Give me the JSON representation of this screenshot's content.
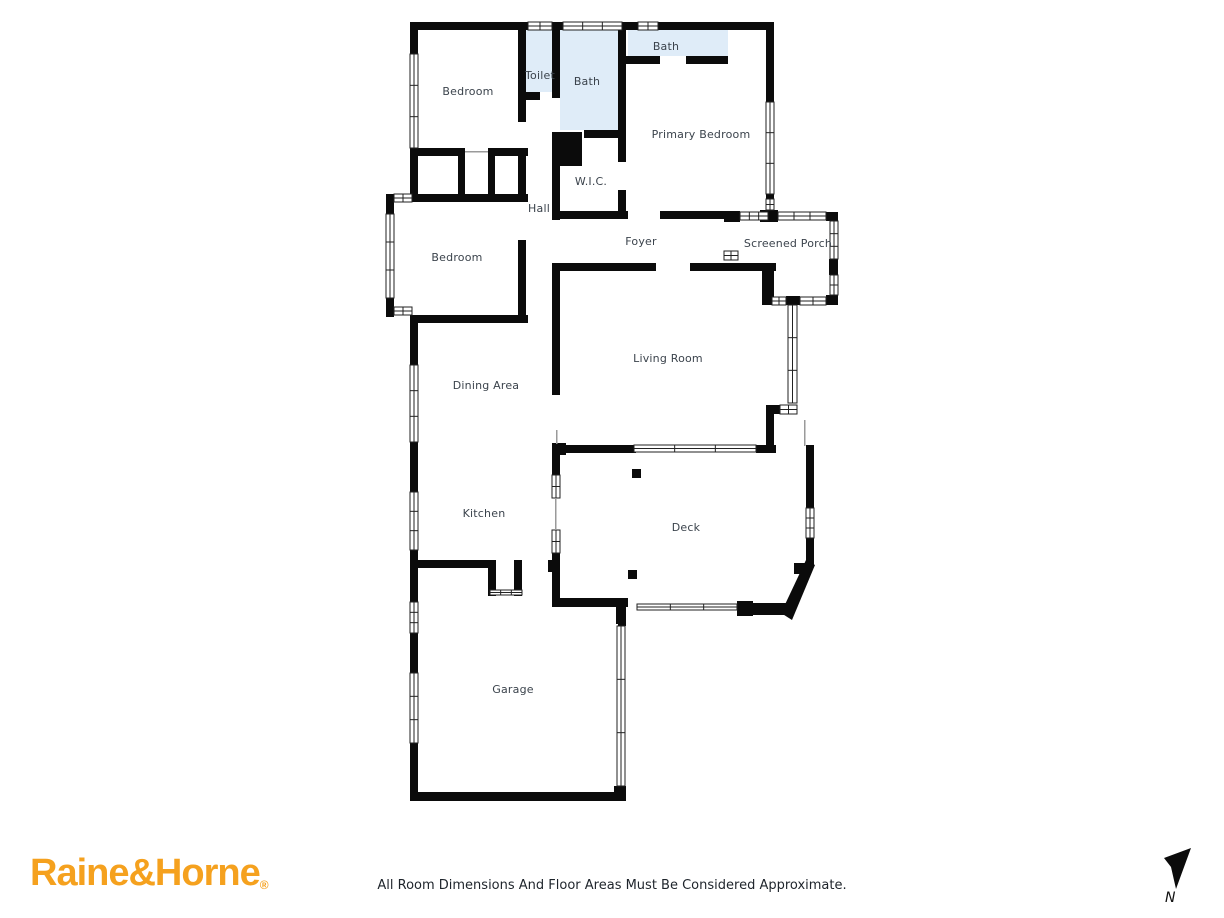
{
  "page": {
    "background": "#ffffff",
    "disclaimer": "All Room Dimensions And Floor Areas Must Be Considered Approximate."
  },
  "branding": {
    "logo_text": "Raine&Horne",
    "registered_mark": "®",
    "logo_color": "#F5A11E"
  },
  "compass": {
    "label": "N"
  },
  "floorplan": {
    "wall_color": "#0b0b0b",
    "bath_fill": "#dfecf8",
    "label_color": "#3b434c",
    "window_line_color": "#222222",
    "rooms": [
      {
        "id": "bedroom-top",
        "label": "Bedroom"
      },
      {
        "id": "toilet",
        "label": "Toilet"
      },
      {
        "id": "bath-main",
        "label": "Bath"
      },
      {
        "id": "bath-ensuite",
        "label": "Bath"
      },
      {
        "id": "primary-bedroom",
        "label": "Primary Bedroom"
      },
      {
        "id": "wic",
        "label": "W.I.C."
      },
      {
        "id": "hall",
        "label": "Hall"
      },
      {
        "id": "bedroom-left",
        "label": "Bedroom"
      },
      {
        "id": "foyer",
        "label": "Foyer"
      },
      {
        "id": "screened-porch",
        "label": "Screened Porch"
      },
      {
        "id": "living-room",
        "label": "Living Room"
      },
      {
        "id": "dining-area",
        "label": "Dining Area"
      },
      {
        "id": "kitchen",
        "label": "Kitchen"
      },
      {
        "id": "deck",
        "label": "Deck"
      },
      {
        "id": "garage",
        "label": "Garage"
      }
    ]
  }
}
